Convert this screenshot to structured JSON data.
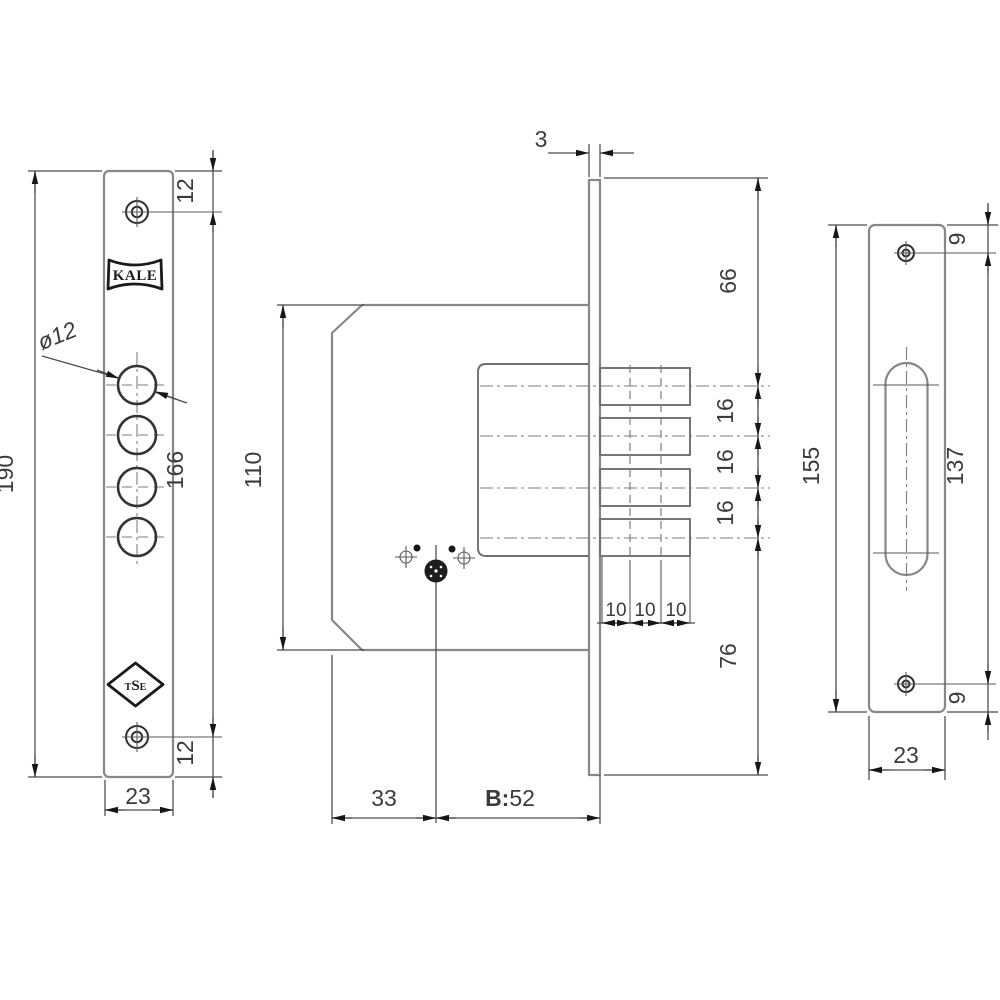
{
  "colors": {
    "object_line": "#878787",
    "dimension_line": "#4a4a4a",
    "text": "#3b3b3b",
    "logo": "#1a1a1a"
  },
  "front_view": {
    "brand_logo": "KALE",
    "cert_logo": {
      "t": "T",
      "s": "S",
      "e": "E"
    },
    "dims": {
      "overall_length": "190",
      "top_screw_offset": "12",
      "screw_spacing": "166",
      "bottom_screw_offset": "12",
      "plate_width": "23",
      "bolt_hole_diameter": "ø12"
    }
  },
  "side_view": {
    "dims": {
      "faceplate_thickness": "3",
      "case_depth": "110",
      "top_to_first_bolt": "66",
      "bolt_pitch_a": "16",
      "bolt_pitch_b": "16",
      "bolt_pitch_c": "16",
      "last_bolt_to_bottom": "76",
      "throw_step_a": "10",
      "throw_step_b": "10",
      "throw_step_c": "10",
      "edge_to_cylinder": "33",
      "backset_prefix": "B:",
      "backset_value": "52"
    }
  },
  "strike_view": {
    "dims": {
      "overall_length": "155",
      "top_screw_offset": "9",
      "screw_spacing": "137",
      "bottom_screw_offset": "9",
      "plate_width": "23"
    }
  }
}
